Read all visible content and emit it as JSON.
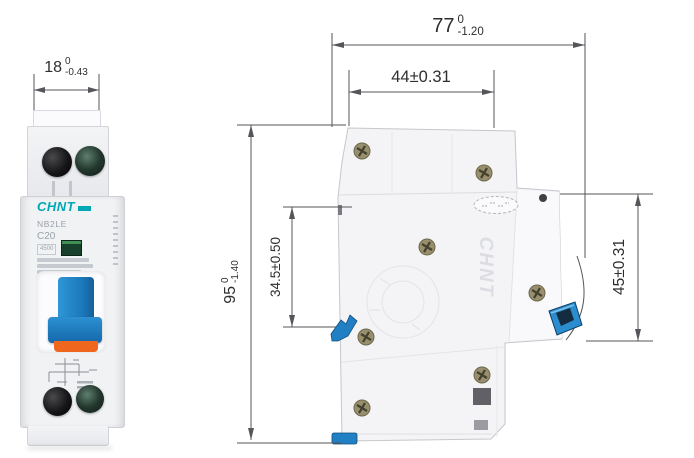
{
  "canvas": {
    "width": 694,
    "height": 458,
    "background": "#ffffff"
  },
  "colors": {
    "dimension_line": "#55555a",
    "dimension_text": "#2e2e30",
    "brand_teal": "#00a8b5",
    "toggle_blue": "#2187cb",
    "clip_blue": "#2180c4",
    "accent_orange": "#ef671f",
    "body_gray": "#f3f3f5"
  },
  "front_view": {
    "dim_width": {
      "nominal": "18",
      "tol_upper": "0",
      "tol_lower": "-0.43"
    },
    "label": {
      "brand": "CHNT",
      "model": "NB2LE",
      "rating": "C20",
      "breaking_capacity": "4500"
    }
  },
  "side_view": {
    "dim_total_depth": {
      "nominal": "77",
      "tol_upper": "0",
      "tol_lower": "-1.20"
    },
    "dim_mount_depth": {
      "text": "44±0.31"
    },
    "dim_height": {
      "nominal": "95",
      "tol_upper": "0",
      "tol_lower": "-1.40"
    },
    "dim_rail_offset": {
      "text": "34.5±0.50"
    },
    "dim_front_height": {
      "text": "45±0.31"
    },
    "embossed_brand": "CHNT"
  }
}
